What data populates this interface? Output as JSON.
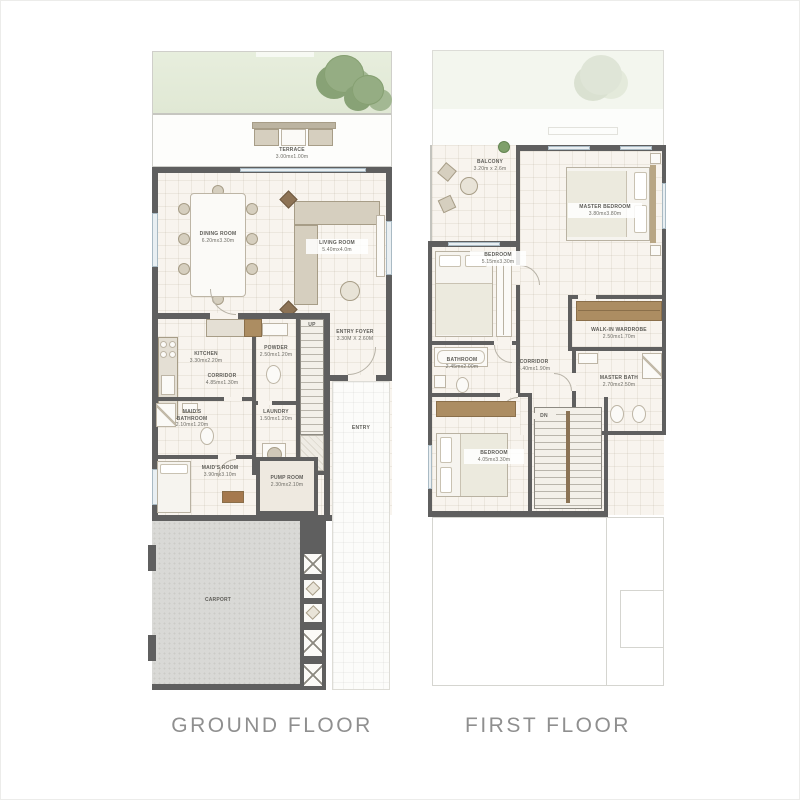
{
  "ground": {
    "title": "GROUND FLOOR",
    "rooms": {
      "terrace": {
        "name": "TERRACE",
        "dims": "3.00mx1.00m"
      },
      "dining_room": {
        "name": "DINING ROOM",
        "dims": "6.20mx3.30m"
      },
      "living_room": {
        "name": "LIVING ROOM",
        "dims": "5.40mx4.0m"
      },
      "kitchen": {
        "name": "KITCHEN",
        "dims": "3.30mx2.20m"
      },
      "corridor": {
        "name": "CORRIDOR",
        "dims": "4.85mx1.30m"
      },
      "powder": {
        "name": "POWDER",
        "dims": "2.50mx1.20m"
      },
      "entry_foyer": {
        "name": "ENTRY FOYER",
        "dims": "3.30M X 2.60M"
      },
      "maids_bathroom": {
        "name": "MAID'S BATHROOM",
        "dims": "2.10mx1.20m"
      },
      "laundry": {
        "name": "LAUNDRY",
        "dims": "1.50mx1.20m"
      },
      "maids_room": {
        "name": "MAID'S ROOM",
        "dims": "3.90mx3.10m"
      },
      "pump_room": {
        "name": "PUMP ROOM",
        "dims": "2.30mx2.10m"
      },
      "carport": {
        "name": "CARPORT"
      }
    },
    "annotations": {
      "up": "UP",
      "entry": "ENTRY"
    }
  },
  "first": {
    "title": "FIRST FLOOR",
    "rooms": {
      "balcony": {
        "name": "BALCONY",
        "dims": "3.20m x 2.6m"
      },
      "bedroom_front": {
        "name": "BEDROOM",
        "dims": "5.15mx3.30m"
      },
      "master_bedroom": {
        "name": "MASTER BEDROOM",
        "dims": "3.80mx3.80m"
      },
      "walk_in_wardrobe": {
        "name": "WALK-IN WARDROBE",
        "dims": "2.50mx1.70m"
      },
      "master_bath": {
        "name": "MASTER BATH",
        "dims": "2.70mx2.50m"
      },
      "bathroom": {
        "name": "BATHROOM",
        "dims": "2.45mx2.00m"
      },
      "corridor": {
        "name": "CORRIDOR",
        "dims": "3.40mx1.90m"
      },
      "bedroom_back": {
        "name": "BEDROOM",
        "dims": "4.05mx3.30m"
      }
    },
    "annotations": {
      "dn": "DN"
    }
  },
  "colors": {
    "wall": "#5f5f5f",
    "floor": "#f8f4ee",
    "garden": "#e4ecdb",
    "tree": "#95ad83",
    "carport": "#d9d9d6",
    "wood": "#ac8d62",
    "label_text": "#5e5d58",
    "title_text": "#8f8f8f"
  }
}
